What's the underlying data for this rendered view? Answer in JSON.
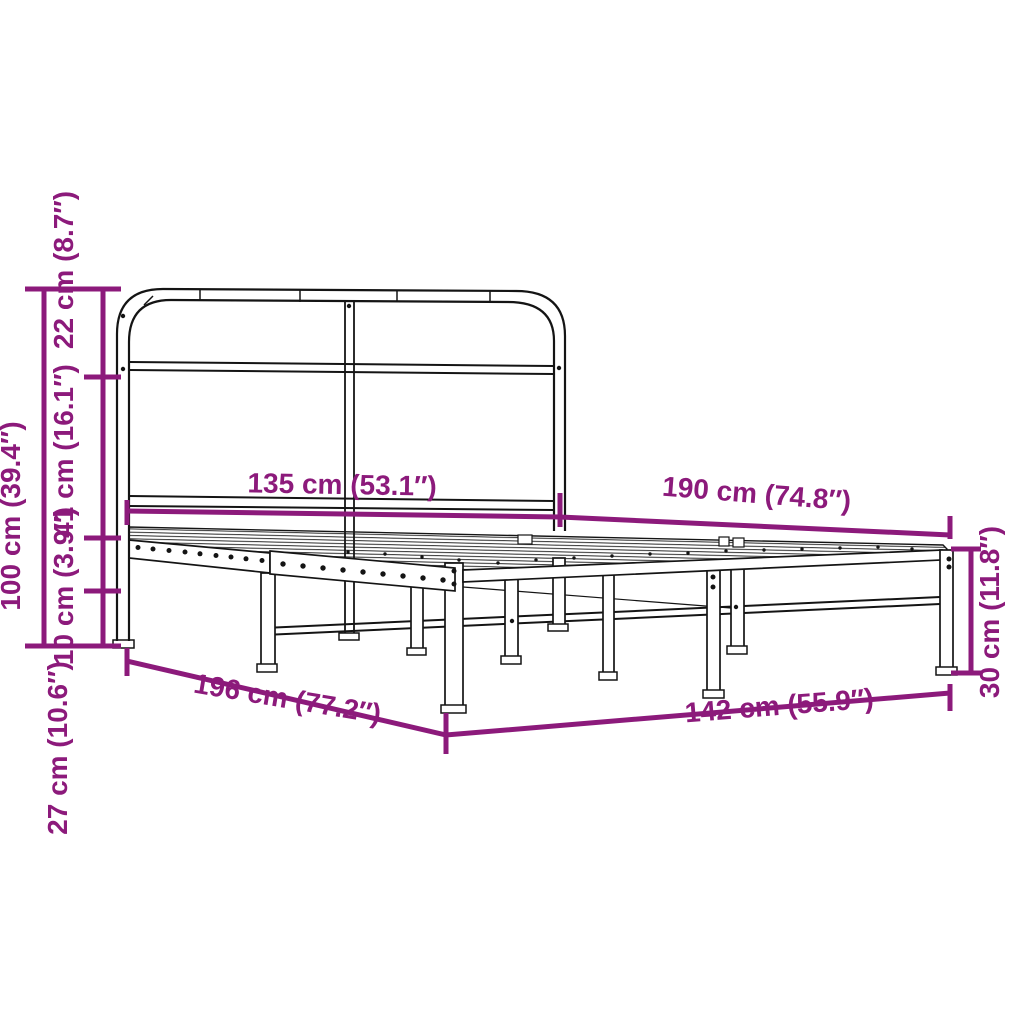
{
  "page": {
    "background": "#ffffff"
  },
  "diagram": {
    "subject": "metal bed frame with headboard dimension diagram",
    "accent_color": "#8C1A7B",
    "line_color": "#141414",
    "labels": {
      "total_height": "100 cm (39.4″)",
      "headboard_top": "22 cm (8.7″)",
      "headboard_panel": "41 cm (16.1″)",
      "frame_rail": "10 cm (3.9″)",
      "under_clearance": "27 cm (10.6″)",
      "headboard_width": "135 cm (53.1″)",
      "sleeping_length": "190 cm (74.8″)",
      "foot_end_height": "30 cm (11.8″)",
      "total_length": "196 cm (77.2″)",
      "total_width": "142 cm (55.9″)"
    }
  }
}
